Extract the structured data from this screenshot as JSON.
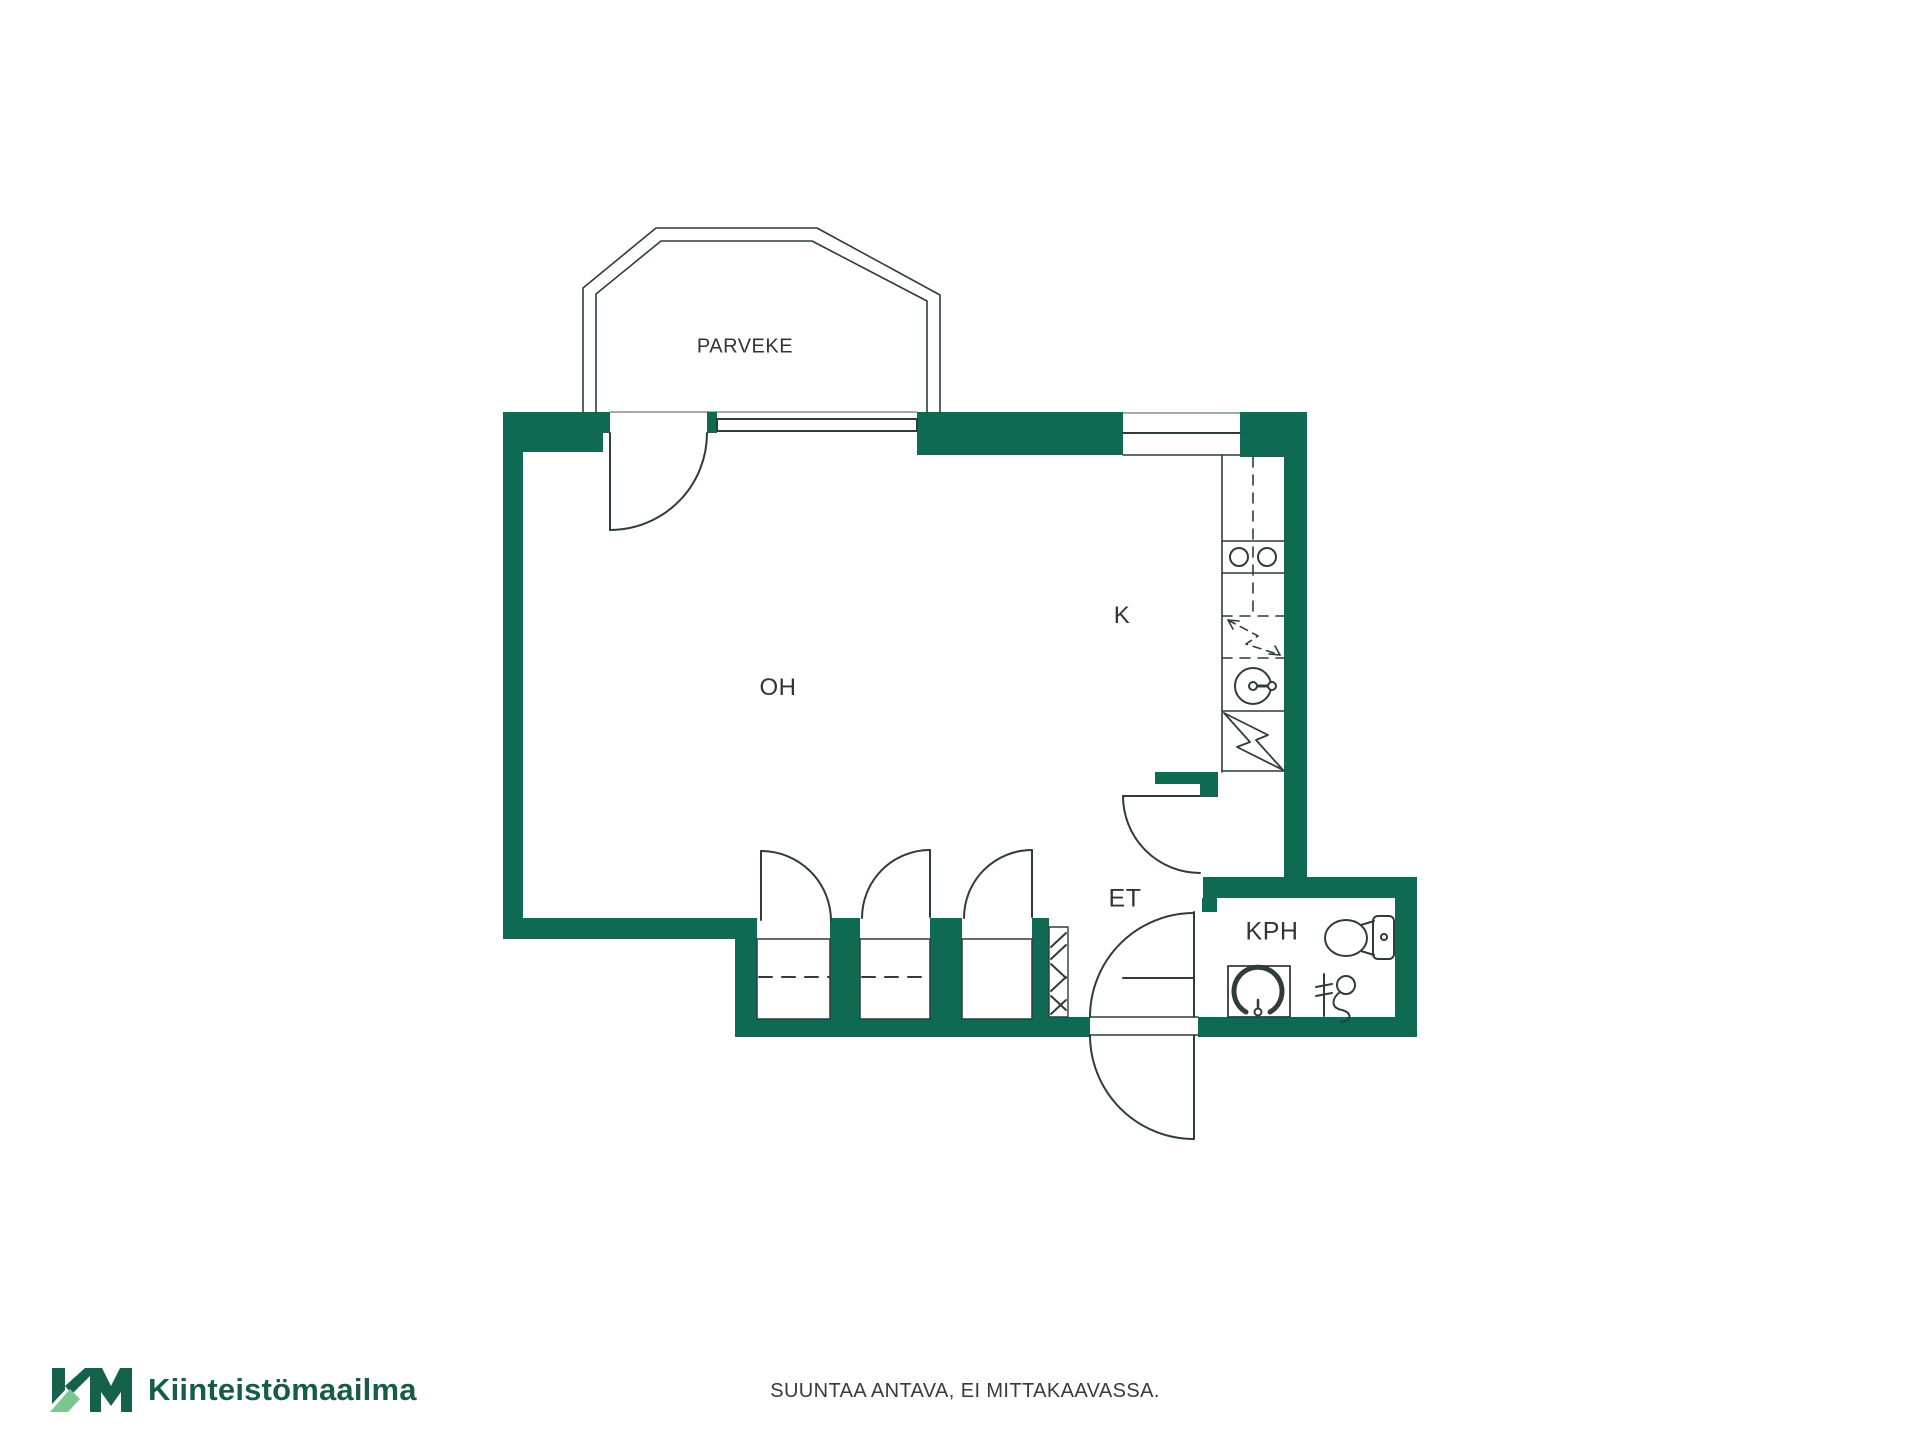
{
  "page": {
    "background": "#ffffff"
  },
  "floorplan": {
    "labels": {
      "balcony": "PARVEKE",
      "living_room": "OH",
      "kitchen": "K",
      "entry": "ET",
      "bathroom": "KPH"
    },
    "colors": {
      "wall": "#0E6A53",
      "line": "#2F3D38",
      "threshold": "#9FACA7",
      "text": "#333333"
    },
    "icons": [
      "stove-icon",
      "sink-icon",
      "dishwasher-reservation-icon",
      "electrical-panel-icon",
      "washbasin-icon",
      "toilet-icon",
      "shower-mixer-icon",
      "wardrobe-rail-dashes",
      "shaft-hatch-icon"
    ]
  },
  "footer": {
    "brand_name": "Kiinteistömaailma",
    "brand_color_dark": "#16614E",
    "brand_color_light": "#7CC78F",
    "disclaimer": "SUUNTAA ANTAVA, EI MITTAKAAVASSA."
  }
}
